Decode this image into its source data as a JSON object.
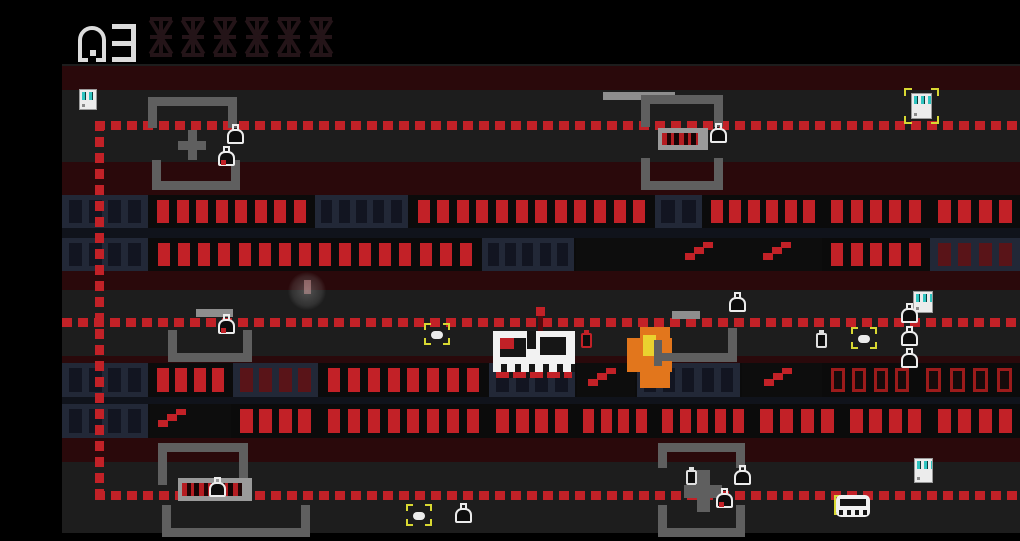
{
  "hud": {
    "level": "3",
    "slot_count": 6,
    "digit_color": "#dcdcdc",
    "slot_color": "#241418"
  },
  "scene": {
    "stage": {
      "w": 1020,
      "h": 541,
      "bg": "#000000"
    },
    "field": {
      "x": 62,
      "y": 64,
      "w": 958,
      "h": 469,
      "bg": "#1d1d1d"
    },
    "palette": {
      "maroon": "#2a090b",
      "row_base": "#0b0b0b",
      "separator": "#10131b",
      "dash_red": "#c22127",
      "lit_win": "#c22127",
      "navy_bg": "#222837",
      "navy_win": "#121521",
      "dim_win": "#591418",
      "outline_border": "#9c1b1b",
      "outline_fill": "#160b0b",
      "dark_seg": "#0d0d0d",
      "bracket_gray": "#5f5f5f",
      "ledge_gray": "#8e8e8e",
      "sign_gray": "#9a9a9a",
      "sign_panel": "#151010",
      "yellow": "#d8d832",
      "teal": "#2fc4c0",
      "white": "#ececec",
      "skull_white": "#f2f2f2",
      "skull_dark": "#161616",
      "flame_orange": "#e2761c",
      "flame_yellow": "#ead22f",
      "trail_red": "#55090d"
    },
    "bands": [
      {
        "name": "maroon-band-top",
        "y": 66,
        "h": 24
      },
      {
        "name": "maroon-band-2",
        "y": 162,
        "h": 33
      },
      {
        "name": "maroon-band-3",
        "y": 271,
        "h": 19
      },
      {
        "name": "maroon-band-4",
        "y": 356,
        "h": 9
      },
      {
        "name": "maroon-band-5",
        "y": 438,
        "h": 24
      }
    ],
    "row_bases": [
      {
        "name": "upper-building-block",
        "y": 195,
        "h": 76
      },
      {
        "name": "lower-building-block",
        "y": 363,
        "h": 75
      }
    ],
    "separators": [
      {
        "name": "row-separator-upper",
        "y": 228,
        "h": 10
      },
      {
        "name": "row-separator-lower",
        "y": 397,
        "h": 7
      }
    ],
    "rows": [
      {
        "y": 195,
        "h": 33,
        "segments": [
          {
            "x": 62,
            "w": 86,
            "style": "unlit",
            "n": 4
          },
          {
            "x": 150,
            "w": 163,
            "style": "lit",
            "n": 8
          },
          {
            "x": 315,
            "w": 93,
            "style": "unlit",
            "n": 5
          },
          {
            "x": 410,
            "w": 243,
            "style": "lit",
            "n": 12
          },
          {
            "x": 655,
            "w": 47,
            "style": "unlit",
            "n": 2
          },
          {
            "x": 704,
            "w": 118,
            "style": "lit",
            "n": 6
          },
          {
            "x": 824,
            "w": 104,
            "style": "lit",
            "n": 5
          },
          {
            "x": 930,
            "w": 90,
            "style": "lit",
            "n": 4
          }
        ]
      },
      {
        "y": 238,
        "h": 33,
        "segments": [
          {
            "x": 62,
            "w": 86,
            "style": "unlit",
            "n": 4
          },
          {
            "x": 150,
            "w": 330,
            "style": "lit",
            "n": 16
          },
          {
            "x": 482,
            "w": 92,
            "style": "unlit",
            "n": 5
          },
          {
            "x": 576,
            "w": 246,
            "style": "dark",
            "n": 0
          },
          {
            "x": 824,
            "w": 104,
            "style": "lit",
            "n": 5
          },
          {
            "x": 930,
            "w": 90,
            "style": "dim",
            "n": 4
          }
        ]
      },
      {
        "y": 363,
        "h": 34,
        "segments": [
          {
            "x": 62,
            "w": 86,
            "style": "unlit",
            "n": 4
          },
          {
            "x": 150,
            "w": 81,
            "style": "lit",
            "n": 4
          },
          {
            "x": 233,
            "w": 85,
            "style": "dim",
            "n": 4
          },
          {
            "x": 320,
            "w": 167,
            "style": "lit",
            "n": 8
          },
          {
            "x": 489,
            "w": 86,
            "style": "unlit",
            "n": 4
          },
          {
            "x": 577,
            "w": 58,
            "style": "dark",
            "n": 0
          },
          {
            "x": 637,
            "w": 103,
            "style": "unlit",
            "n": 5
          },
          {
            "x": 742,
            "w": 80,
            "style": "dark",
            "n": 0
          },
          {
            "x": 824,
            "w": 92,
            "style": "outline",
            "n": 4
          },
          {
            "x": 918,
            "w": 102,
            "style": "outline",
            "n": 4
          }
        ]
      },
      {
        "y": 404,
        "h": 34,
        "segments": [
          {
            "x": 62,
            "w": 86,
            "style": "unlit",
            "n": 4
          },
          {
            "x": 150,
            "w": 81,
            "style": "dark",
            "n": 0
          },
          {
            "x": 233,
            "w": 85,
            "style": "lit",
            "n": 4
          },
          {
            "x": 320,
            "w": 167,
            "style": "lit",
            "n": 8
          },
          {
            "x": 489,
            "w": 86,
            "style": "lit",
            "n": 4
          },
          {
            "x": 577,
            "w": 76,
            "style": "lit",
            "n": 4
          },
          {
            "x": 655,
            "w": 96,
            "style": "lit",
            "n": 5
          },
          {
            "x": 753,
            "w": 88,
            "style": "lit",
            "n": 4
          },
          {
            "x": 843,
            "w": 85,
            "style": "lit",
            "n": 4
          },
          {
            "x": 930,
            "w": 90,
            "style": "lit",
            "n": 4
          }
        ]
      }
    ],
    "stairs": [
      {
        "x": 685,
        "y": 242
      },
      {
        "x": 763,
        "y": 242
      },
      {
        "x": 588,
        "y": 368
      },
      {
        "x": 764,
        "y": 368
      },
      {
        "x": 158,
        "y": 409
      }
    ],
    "dashed": [
      {
        "name": "dashed-border-top",
        "x": 95,
        "y": 121,
        "w": 925,
        "h": 9,
        "dir": "h"
      },
      {
        "name": "dashed-border-middle",
        "x": 62,
        "y": 318,
        "w": 958,
        "h": 9,
        "dir": "h"
      },
      {
        "name": "dashed-border-bottom",
        "x": 95,
        "y": 491,
        "w": 925,
        "h": 9,
        "dir": "h"
      },
      {
        "name": "dashed-border-left",
        "x": 95,
        "y": 121,
        "w": 9,
        "h": 379,
        "dir": "v"
      }
    ],
    "ledges": [
      {
        "x": 603,
        "y": 92,
        "w": 72,
        "h": 8
      },
      {
        "x": 196,
        "y": 309,
        "w": 37,
        "h": 8
      },
      {
        "x": 672,
        "y": 311,
        "w": 28,
        "h": 8
      }
    ],
    "brackets": [
      {
        "or": "n",
        "x": 148,
        "y": 97,
        "w": 89,
        "h": 31
      },
      {
        "or": "n",
        "x": 641,
        "y": 95,
        "w": 82,
        "h": 32
      },
      {
        "or": "u",
        "x": 152,
        "y": 160,
        "w": 88,
        "h": 30
      },
      {
        "or": "u",
        "x": 641,
        "y": 158,
        "w": 82,
        "h": 32
      },
      {
        "or": "u",
        "x": 168,
        "y": 330,
        "w": 84,
        "h": 32
      },
      {
        "or": "u",
        "x": 655,
        "y": 328,
        "w": 82,
        "h": 34
      },
      {
        "or": "n",
        "x": 158,
        "y": 443,
        "w": 90,
        "h": 42
      },
      {
        "or": "n",
        "x": 658,
        "y": 443,
        "w": 87,
        "h": 25
      },
      {
        "or": "u",
        "x": 162,
        "y": 505,
        "w": 148,
        "h": 32
      },
      {
        "or": "u",
        "x": 658,
        "y": 505,
        "w": 87,
        "h": 32
      }
    ],
    "pluses": [
      {
        "x": 178,
        "y": 130,
        "w": 28,
        "h": 30,
        "t": 9
      },
      {
        "x": 684,
        "y": 470,
        "w": 38,
        "h": 42,
        "t": 13
      }
    ],
    "signs": [
      {
        "x": 658,
        "y": 128,
        "w": 50,
        "h": 22
      },
      {
        "x": 178,
        "y": 478,
        "w": 74,
        "h": 23
      }
    ],
    "items": [
      {
        "type": "fridge",
        "x": 79,
        "y": 89,
        "w": 18,
        "h": 21
      },
      {
        "type": "fridge",
        "x": 911,
        "y": 93,
        "w": 21,
        "h": 26,
        "brackets": {
          "x": 904,
          "y": 88,
          "w": 35,
          "h": 36
        }
      },
      {
        "type": "bag",
        "x": 227,
        "y": 124
      },
      {
        "type": "bag-red",
        "x": 218,
        "y": 146
      },
      {
        "type": "bag",
        "x": 710,
        "y": 123
      },
      {
        "type": "bag-red",
        "x": 218,
        "y": 314
      },
      {
        "type": "pill",
        "x": 424,
        "y": 323
      },
      {
        "type": "bottle-red",
        "x": 581,
        "y": 330
      },
      {
        "type": "bag",
        "x": 729,
        "y": 292
      },
      {
        "type": "bottle",
        "x": 816,
        "y": 330
      },
      {
        "type": "pill",
        "x": 851,
        "y": 327
      },
      {
        "type": "fridge",
        "x": 913,
        "y": 291,
        "w": 20,
        "h": 22
      },
      {
        "type": "bag",
        "x": 901,
        "y": 303
      },
      {
        "type": "bag",
        "x": 901,
        "y": 326
      },
      {
        "type": "bag",
        "x": 901,
        "y": 348
      },
      {
        "type": "bottle",
        "x": 686,
        "y": 467
      },
      {
        "type": "bag",
        "x": 734,
        "y": 465
      },
      {
        "type": "bag-red",
        "x": 716,
        "y": 488
      },
      {
        "type": "fridge",
        "x": 914,
        "y": 458,
        "w": 19,
        "h": 25
      },
      {
        "type": "pill",
        "x": 406,
        "y": 504
      },
      {
        "type": "bag",
        "x": 455,
        "y": 503
      },
      {
        "type": "bag",
        "x": 209,
        "y": 477
      },
      {
        "type": "car",
        "x": 834,
        "y": 493
      }
    ],
    "player": {
      "x": 493,
      "y": 331,
      "w": 82,
      "h": 47
    },
    "projectile": {
      "x": 536,
      "y": 307,
      "w": 9,
      "h": 9,
      "trail": {
        "x": 538,
        "y": 316,
        "w": 5,
        "h": 16
      }
    },
    "flame": {
      "x": 627,
      "y": 327,
      "w": 46,
      "h": 62
    },
    "ghost": {
      "x": 288,
      "y": 272,
      "d": 38
    }
  }
}
